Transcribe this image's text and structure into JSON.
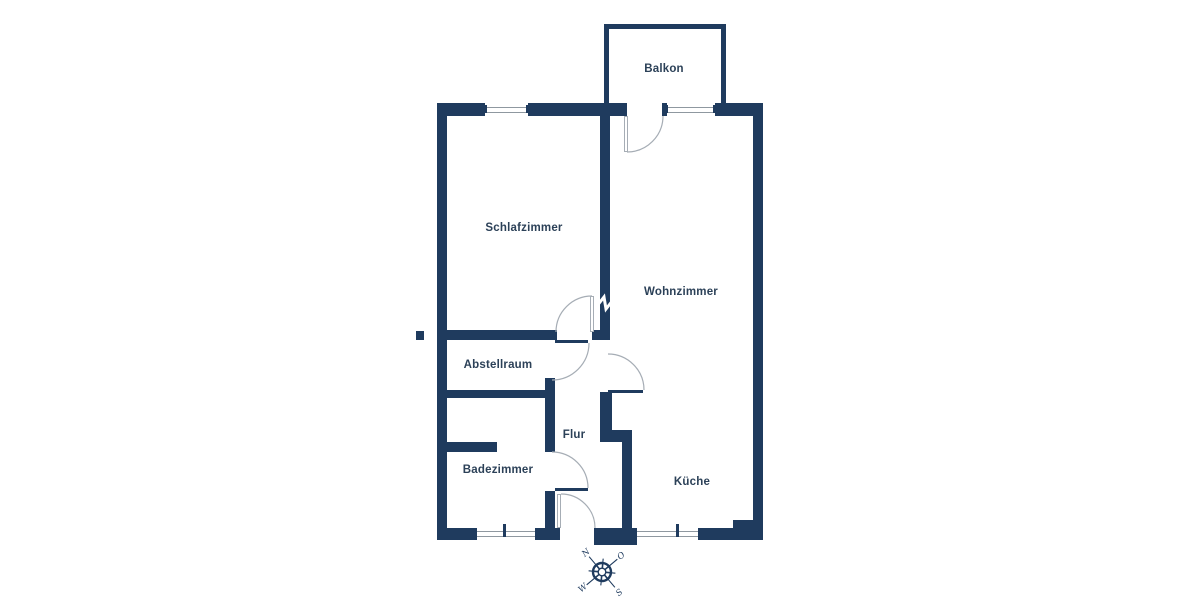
{
  "floor_plan": {
    "rooms": [
      {
        "id": "balkon",
        "label": "Balkon"
      },
      {
        "id": "schlafzimmer",
        "label": "Schlafzimmer"
      },
      {
        "id": "wohnzimmer",
        "label": "Wohnzimmer"
      },
      {
        "id": "abstellraum",
        "label": "Abstellraum"
      },
      {
        "id": "flur",
        "label": "Flur"
      },
      {
        "id": "badezimmer",
        "label": "Badezimmer"
      },
      {
        "id": "kueche",
        "label": "Küche"
      }
    ],
    "compass": {
      "north_label": "N",
      "east_label": "O",
      "south_label": "S",
      "west_label": "W"
    },
    "colors": {
      "wall": "#1f3b5e",
      "label": "#2c4158",
      "door_arc": "#a6adb5",
      "window_line": "#8f98a0",
      "background": "#ffffff"
    }
  }
}
